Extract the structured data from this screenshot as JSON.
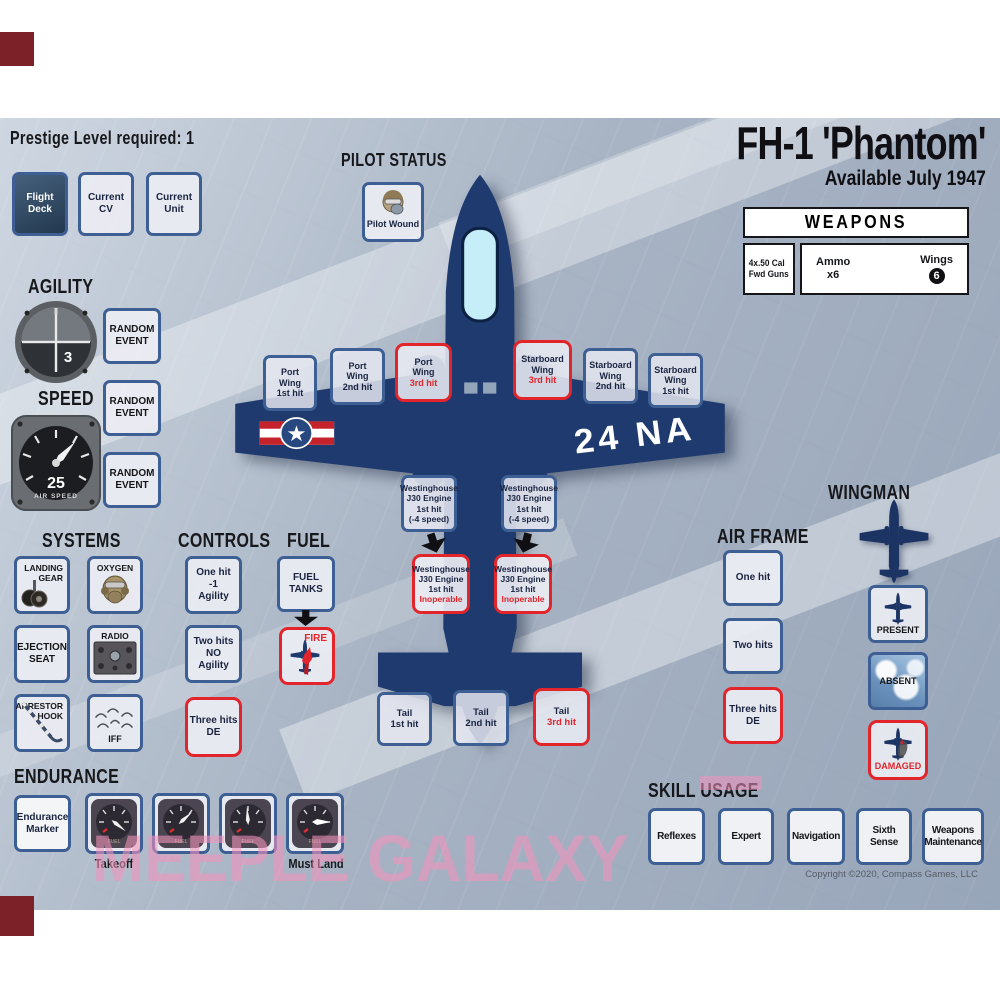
{
  "theme": {
    "accent_red": "#e1252b",
    "box_border": "#3d5f93",
    "plane_navy": "#1e3a6e",
    "watermark_pink": "#f392bc"
  },
  "page": {
    "prestige_label": "Prestige Level required: 1",
    "title": "FH-1 'Phantom'",
    "subtitle": "Available July 1947",
    "copyright": "Copyright ©2020, Compass Games, LLC",
    "watermark": "MEEPLE GALAXY"
  },
  "slots": [
    {
      "label": "Flight\nDeck"
    },
    {
      "label": "Current\nCV"
    },
    {
      "label": "Current\nUnit"
    }
  ],
  "pilot_status": {
    "heading": "PILOT STATUS",
    "box_label": "Pilot Wound"
  },
  "weapons": {
    "heading": "WEAPONS",
    "gun_label": "4x.50 Cal\nFwd Guns",
    "ammo_label": "Ammo",
    "ammo_value": "x6",
    "wings_label": "Wings",
    "wings_value": "6"
  },
  "agility": {
    "heading": "AGILITY",
    "value": "3"
  },
  "speed": {
    "heading": "SPEED",
    "value": "25",
    "dial_label": "AIR SPEED"
  },
  "random_events": [
    {
      "label": "RANDOM\nEVENT"
    },
    {
      "label": "RANDOM\nEVENT"
    },
    {
      "label": "RANDOM\nEVENT"
    }
  ],
  "aircraft": {
    "marking": "24 NA"
  },
  "wing_hits": [
    {
      "name": "Port\nWing",
      "hit": "1st hit",
      "danger": false
    },
    {
      "name": "Port\nWing",
      "hit": "2nd hit",
      "danger": false
    },
    {
      "name": "Port\nWing",
      "hit": "3rd hit",
      "danger": true
    },
    {
      "name": "Starboard\nWing",
      "hit": "3rd hit",
      "danger": true
    },
    {
      "name": "Starboard\nWing",
      "hit": "2nd hit",
      "danger": false
    },
    {
      "name": "Starboard\nWing",
      "hit": "1st hit",
      "danger": false
    }
  ],
  "engines": {
    "first_hit_label": "Westinghouse\nJ30 Engine\n1st hit\n(-4 speed)",
    "inoperable_main": "Westinghouse\nJ30 Engine\n1st hit",
    "inoperable_status": "Inoperable"
  },
  "systems": {
    "heading": "SYSTEMS",
    "boxes": [
      {
        "label": "LANDING\nGEAR",
        "icon": "landing-gear"
      },
      {
        "label": "OXYGEN",
        "icon": "oxygen-mask"
      },
      {
        "label": "EJECTION\nSEAT",
        "icon": ""
      },
      {
        "label": "RADIO",
        "icon": "radio-panel"
      },
      {
        "label": "ARRESTOR\nHOOK",
        "icon": "arrestor-hook"
      },
      {
        "label": "IFF",
        "icon": "iff-waves"
      }
    ]
  },
  "controls": {
    "heading": "CONTROLS",
    "boxes": [
      {
        "label": "One hit\n-1\nAgility",
        "danger": false
      },
      {
        "label": "Two hits\nNO\nAgility",
        "danger": false
      },
      {
        "label": "Three hits\nDE",
        "danger": true
      }
    ]
  },
  "fuel": {
    "heading": "FUEL",
    "tank_label": "FUEL\nTANKS",
    "fire_label": "FIRE"
  },
  "tail_hits": [
    {
      "name": "Tail",
      "hit": "1st hit",
      "danger": false
    },
    {
      "name": "Tail",
      "hit": "2nd hit",
      "danger": false
    },
    {
      "name": "Tail",
      "hit": "3rd hit",
      "danger": true
    }
  ],
  "airframe": {
    "heading": "AIR FRAME",
    "boxes": [
      {
        "label": "One hit",
        "danger": false
      },
      {
        "label": "Two hits",
        "danger": false
      },
      {
        "label": "Three hits\nDE",
        "danger": true
      }
    ]
  },
  "wingman": {
    "heading": "WINGMAN",
    "present_label": "PRESENT",
    "absent_label": "ABSENT",
    "damaged_label": "DAMAGED"
  },
  "endurance": {
    "heading": "ENDURANCE",
    "marker_label": "Endurance\nMarker",
    "first_gauge_label": "Takeoff",
    "last_gauge_label": "Must Land",
    "gauge_dial_label": "FUEL"
  },
  "skills": {
    "heading": "SKILL USAGE",
    "boxes": [
      {
        "label": "Reflexes"
      },
      {
        "label": "Expert"
      },
      {
        "label": "Navigation"
      },
      {
        "label": "Sixth\nSense"
      },
      {
        "label": "Weapons\nMaintenance"
      }
    ]
  }
}
